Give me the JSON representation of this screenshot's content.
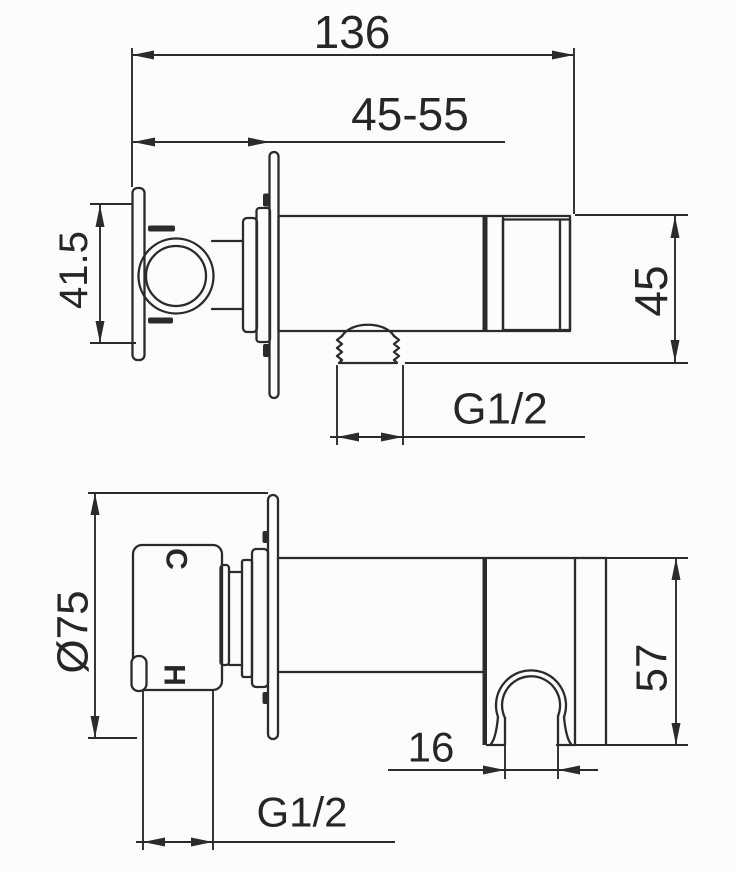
{
  "colors": {
    "background": "#fcfcfc",
    "line": "#2b2b2b",
    "text": "#262626"
  },
  "top_view": {
    "overall_width": "136",
    "mounting_depth_range": "45-55",
    "body_height": "41.5",
    "arm_end_height": "45",
    "outlet_thread": "G1/2"
  },
  "bottom_view": {
    "plate_diameter": "Ø75",
    "holder_depth": "57",
    "hook_opening": "16",
    "inlet_thread": "G1/2",
    "cold_marking": "C",
    "hot_marking": "H"
  }
}
